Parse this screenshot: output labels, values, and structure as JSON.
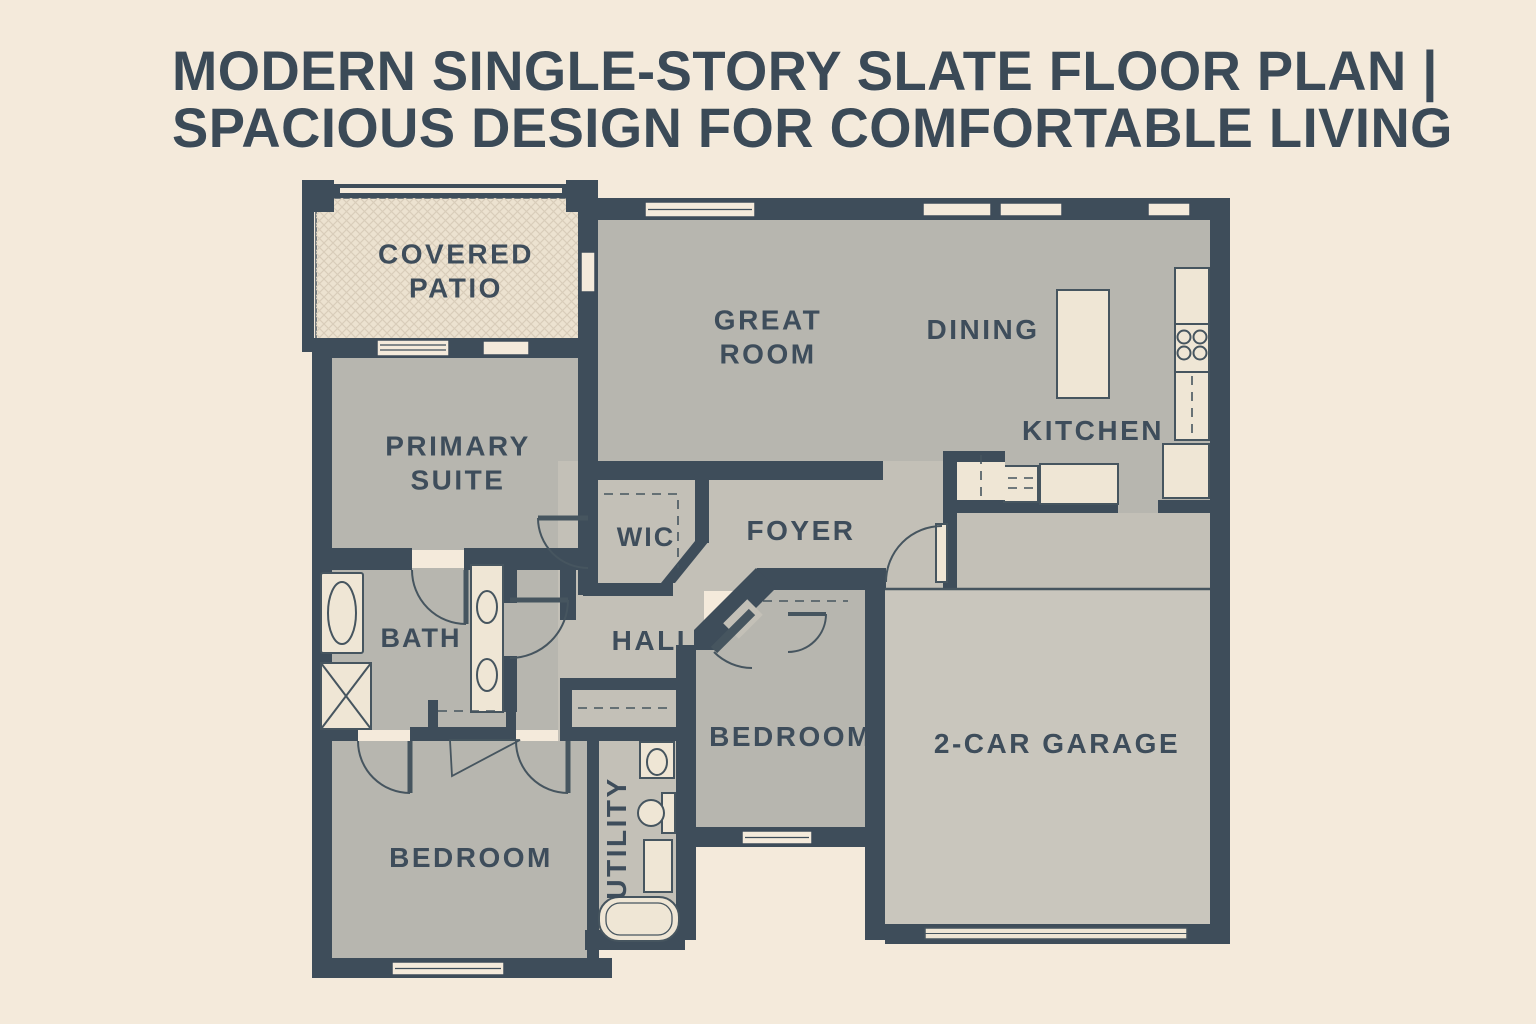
{
  "title": {
    "line1": "MODERN SINGLE-STORY SLATE FLOOR PLAN |",
    "line2": "SPACIOUS DESIGN FOR COMFORTABLE LIVING"
  },
  "rooms": {
    "covered_patio": {
      "label": "COVERED\nPATIO"
    },
    "great_room": {
      "label": "GREAT\nROOM"
    },
    "dining": {
      "label": "DINING"
    },
    "kitchen": {
      "label": "KITCHEN"
    },
    "primary_suite": {
      "label": "PRIMARY\nSUITE"
    },
    "wic": {
      "label": "WIC"
    },
    "foyer": {
      "label": "FOYER"
    },
    "bath": {
      "label": "BATH"
    },
    "hall": {
      "label": "HALL"
    },
    "bedroom_middle": {
      "label": "BEDROOM"
    },
    "garage": {
      "label": "2-CAR GARAGE"
    },
    "bedroom_left": {
      "label": "BEDROOM"
    },
    "utility": {
      "label": "UTILITY"
    }
  },
  "colors": {
    "background": "#f4eadb",
    "wall": "#3e4d5a",
    "room_fill": "#b7b6af",
    "hall_fill": "#c3c0b7",
    "garage_fill": "#c9c6bd",
    "patio_fill": "#ece2d0",
    "patio_hatch_line": "#d9cdba",
    "fixture_fill": "#efe6d5",
    "line": "#46555f",
    "title_text": "#3b4a57",
    "label_text": "#3e4d5b"
  }
}
